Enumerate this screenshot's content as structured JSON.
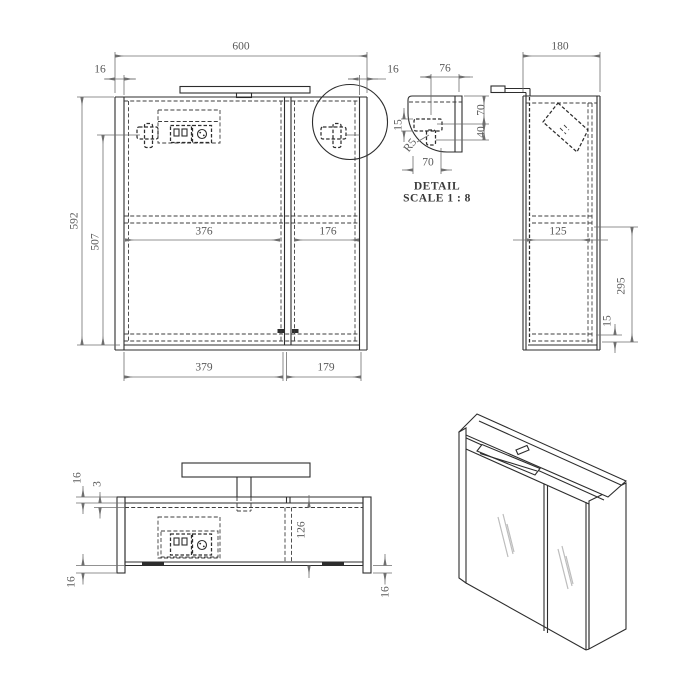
{
  "sheet": {
    "background": "#ffffff",
    "object_line_color": "#2d2d2d",
    "dim_color": "#6f6f6f"
  },
  "front_view": {
    "dims": {
      "overall_width": "600",
      "left_panel_thickness": "16",
      "right_panel_thickness": "16",
      "overall_height": "592",
      "hinge_to_bottom": "507",
      "inner_left_width": "376",
      "inner_right_width": "176",
      "left_door_width": "379",
      "right_door_width": "179"
    }
  },
  "detail_view": {
    "title": "DETAIL",
    "scale_note": "SCALE 1 : 8",
    "dims": {
      "top_offset": "76",
      "upper_height": "70",
      "lower_height": "40",
      "hinge_plate": "15",
      "corner_radius": "R5",
      "bottom_offset": "70"
    }
  },
  "side_view": {
    "dims": {
      "depth": "180",
      "inner_depth": "125",
      "shelf_to_bottom": "295",
      "bottom_panel": "15"
    }
  },
  "top_view": {
    "dims": {
      "door_thickness": "16",
      "back_panel_gap": "3",
      "left_panel_overhang": "16",
      "inner_depth": "126",
      "right_panel_overhang": "16"
    }
  }
}
